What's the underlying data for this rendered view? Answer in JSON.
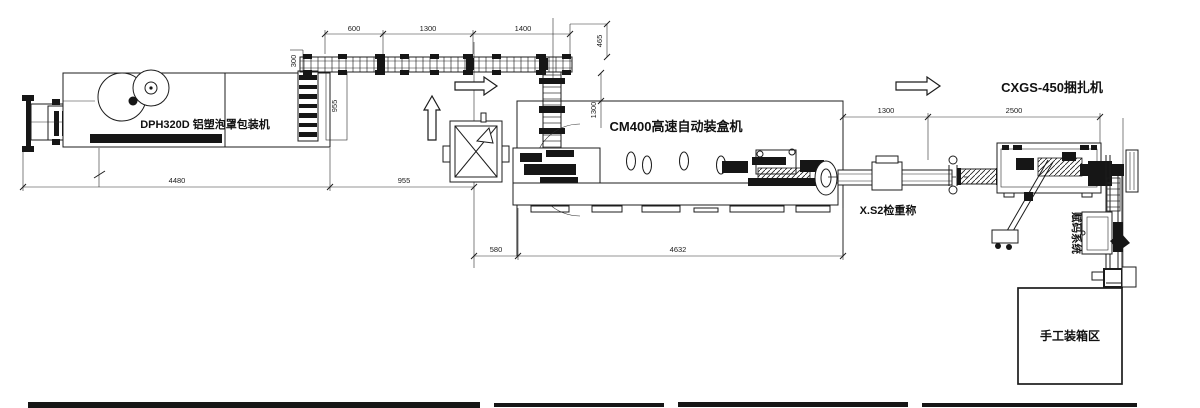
{
  "drawing": {
    "title_context": "packaging line layout",
    "background_color": "#ffffff",
    "line_color": "#1c1c1c",
    "labels": {
      "blister_machine": "DPH320D 铝塑泡罩包装机",
      "cartoner": "CM400高速自动装盒机",
      "strapper": "CXGS-450捆扎机",
      "checkweigher": "X.S2检重称",
      "coding_system": "赋码系统",
      "manual_packing": "手工装箱区"
    },
    "dimensions": {
      "conveyor_600": "600",
      "conveyor_1300": "1300",
      "conveyor_1400": "1400",
      "conveyor_height_465": "465",
      "riser_width_300": "300",
      "riser_height_955": "955",
      "blister_length_4480": "4480",
      "gap_955": "955",
      "infeed_drop_1300": "1300",
      "cartoner_offset_580": "580",
      "cartoner_length_4632": "4632",
      "checkweigher_span_1300": "1300",
      "strapper_span_2500": "2500"
    }
  }
}
